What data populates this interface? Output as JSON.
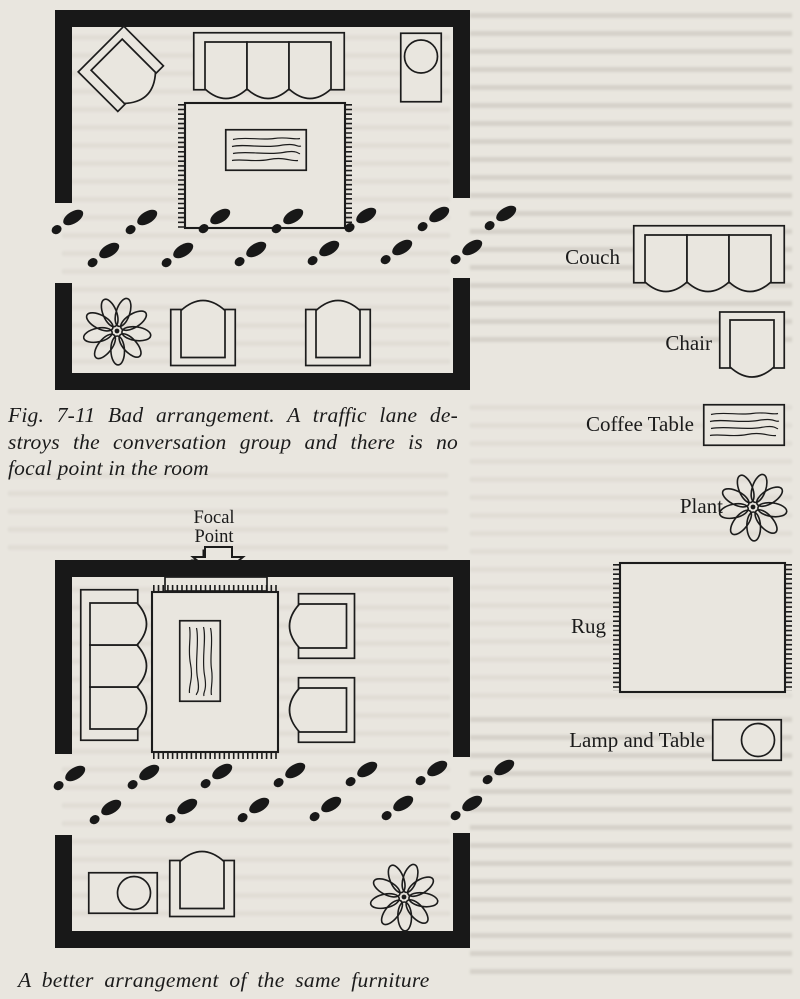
{
  "palette": {
    "paper": "#e9e6df",
    "ink": "#1c1c1c"
  },
  "figure": {
    "caption_bad_lines": [
      "Fig. 7-11 Bad arrangement. A traffic lane de-",
      "stroys the conversation group and there is no",
      "focal point in the room"
    ],
    "caption_better": "A better arrangement of the same furniture",
    "focal_point_label": "Focal Point"
  },
  "legend": {
    "items": [
      {
        "label": "Couch"
      },
      {
        "label": "Chair"
      },
      {
        "label": "Coffee Table"
      },
      {
        "label": "Plant"
      },
      {
        "label": "Rug"
      },
      {
        "label": "Lamp and Table"
      }
    ]
  },
  "diagrams": {
    "bad_room": {
      "description": "Floor plan: diagonal chair, couch and lamp table at top, rug with coffee table in center, plant and two chairs at bottom; footprint traffic lane cuts through the middle between wall openings"
    },
    "better_room": {
      "description": "Floor plan: focal-point hearth on top wall; couch, coffee table on rug and two chairs grouped around it; footprint traffic lane passes behind the group; lamp table, chair and plant along bottom wall"
    }
  }
}
